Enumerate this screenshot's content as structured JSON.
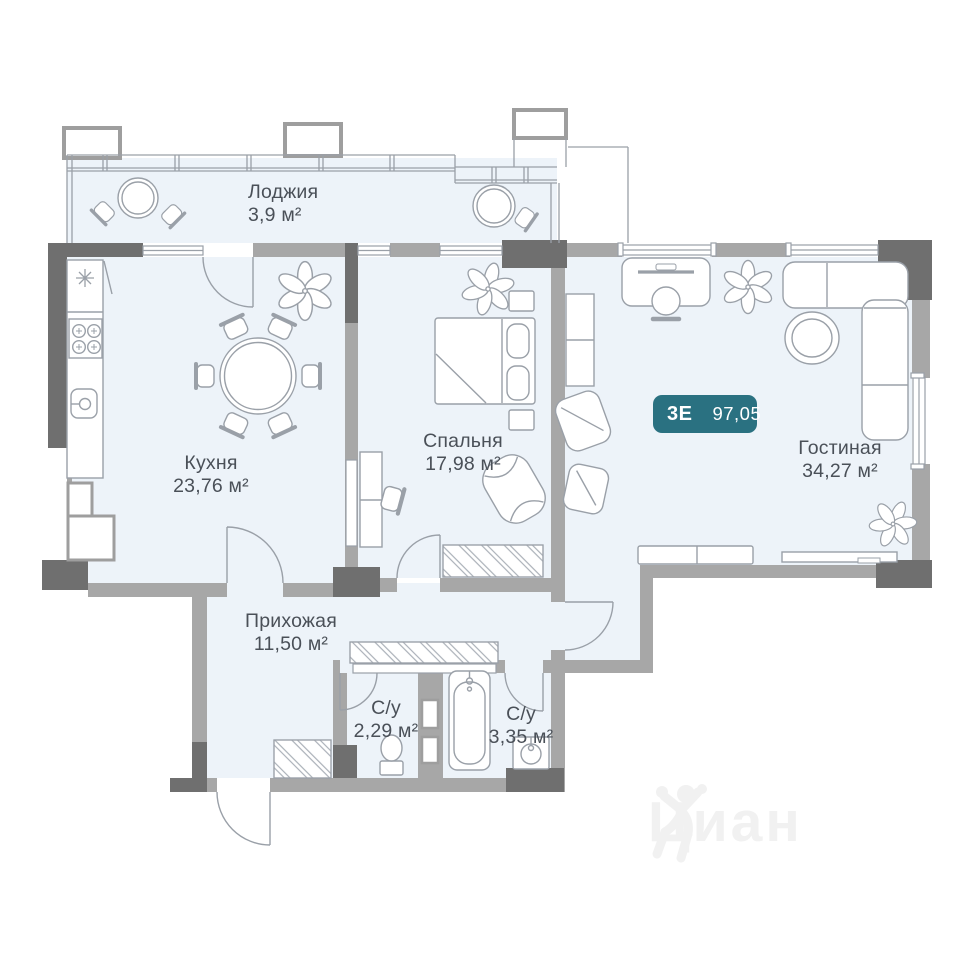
{
  "plan": {
    "badge": {
      "type_label": "3Е",
      "area_value": "97,05"
    },
    "rooms": [
      {
        "key": "loggia",
        "name": "Лоджия",
        "area": "3,9 м²"
      },
      {
        "key": "kitchen",
        "name": "Кухня",
        "area": "23,76 м²"
      },
      {
        "key": "bedroom",
        "name": "Спальня",
        "area": "17,98 м²"
      },
      {
        "key": "living-room",
        "name": "Гостиная",
        "area": "34,27 м²"
      },
      {
        "key": "hallway",
        "name": "Прихожая",
        "area": "11,50 м²"
      },
      {
        "key": "bathroom-small",
        "name": "С/у",
        "area": "2,29 м²"
      },
      {
        "key": "bathroom-large",
        "name": "С/у",
        "area": "3,35 м²"
      }
    ],
    "watermark": {
      "brand": "Циан"
    },
    "icons": [
      "plant-icon",
      "stove-icon",
      "sink-icon",
      "bathtub-icon",
      "toilet-icon",
      "washbasin-icon",
      "lamp-star-icon",
      "person-logo-icon"
    ],
    "colors": {
      "floor": "#edf3f9",
      "wall_dark": "#6f6f6f",
      "wall_medium": "#a7a7a7",
      "outline": "#9aa0a8",
      "badge_bg": "#2a7181",
      "badge_text": "#ffffff",
      "label_text": "#4a5058",
      "watermark": "#f1f1f1"
    }
  }
}
